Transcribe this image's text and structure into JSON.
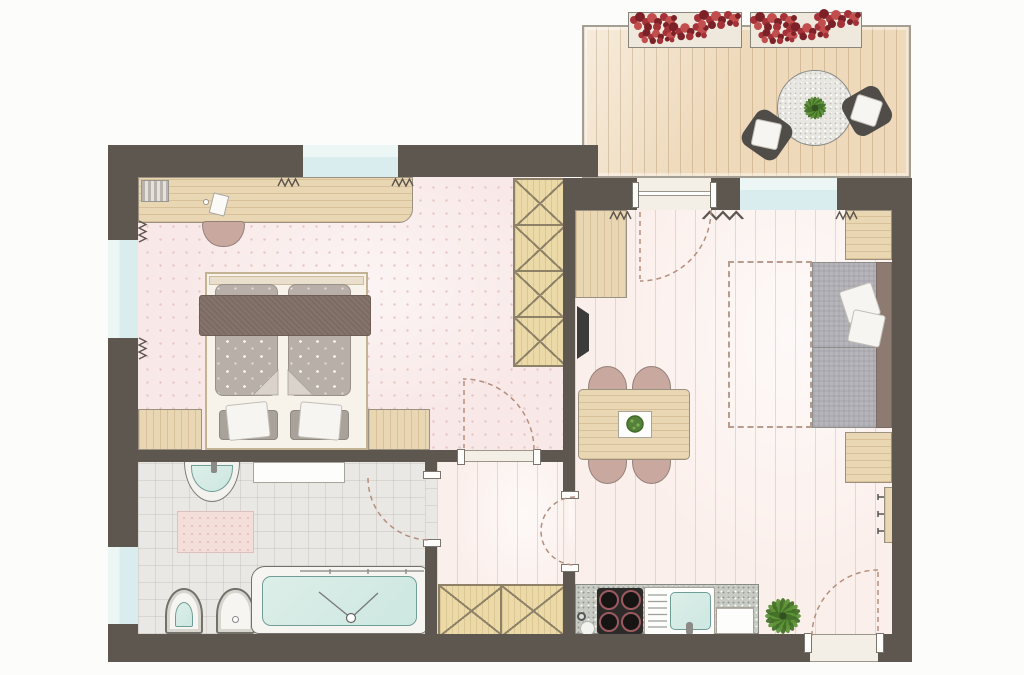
{
  "canvas": {
    "width": 1024,
    "height": 675
  },
  "colors": {
    "wall": "#5e574f",
    "background": "#fcfcfb",
    "bedroom_floor": "#f8e8e7",
    "bedroom_dot": "#e8c6c4",
    "living_floor": "#fbefeb",
    "plank_line": "#e3c2b8",
    "bath_floor": "#eae8e4",
    "bath_grid": "#d5d1cb",
    "deck": "#eed9ba",
    "deck_line": "#c8a87c",
    "glass": "#d9edee",
    "glass_light": "#ecf6f5",
    "wood": "#e9d6b2",
    "wood_border": "#9b9181",
    "wardrobe": "#ecd9a8",
    "wardrobe_line": "#8d8168",
    "blanket": "#7c6b62",
    "mattress": "#b8b0a8",
    "pillow_gray": "#a9a29a",
    "linen": "#f6f5f2",
    "chair_pink": "#c9a8a0",
    "chair_border": "#94817a",
    "sofa_gray": "#b5b5ba",
    "sofa_back": "#8d7a71",
    "granite": "#c8cac4",
    "granite_table": "#e9e7e2",
    "cooktop": "#2d2b29",
    "burner_ring": "#9c5a60",
    "teal": "#cde7e1",
    "teal_border": "#6f9e97",
    "arc": "#b58e7d",
    "rug_dash": "#b89c8e",
    "tv": "#3b3b3b",
    "green": "#5f9339",
    "green_dark": "#437029",
    "red": "#a53238",
    "red_dark": "#7c2127",
    "red_mid": "#c34e4e",
    "threshold": "#f3efe7",
    "threshold_line": "#9b958a",
    "metal": "#8a8a86"
  },
  "building": {
    "rooms": [
      {
        "id": "bedroom",
        "furniture": [
          "desk",
          "desk-chair",
          "double-bed",
          "bed-blanket",
          "bed-pillows",
          "wall-wardrobe-4-sections",
          "bench-left",
          "bench-right"
        ]
      },
      {
        "id": "bathroom",
        "furniture": [
          "washbasin",
          "wall-shelf",
          "bath-mat",
          "toilet",
          "bidet",
          "bathtub"
        ]
      },
      {
        "id": "hallway",
        "furniture": [
          "closet-2-sections"
        ]
      },
      {
        "id": "living-dining-kitchen",
        "furniture": [
          "sideboard",
          "tv",
          "dining-table",
          "dining-chairs-4",
          "serving-tray",
          "tray-plant",
          "sofa",
          "sofa-pillows-2",
          "side-cabinet-top",
          "side-cabinet-bottom",
          "rug-outline",
          "coat-rack",
          "kitchenette",
          "cooktop-4-burners",
          "kitchen-sink",
          "drainboard",
          "worktop-board",
          "potted-plant"
        ]
      },
      {
        "id": "balcony",
        "furniture": [
          "flower-box-left",
          "flower-box-right",
          "round-table",
          "outdoor-chairs-2",
          "table-plant"
        ]
      }
    ],
    "doors": [
      "balcony-sliding-door",
      "bedroom-door",
      "bathroom-door",
      "hallway-door",
      "entrance-door"
    ],
    "windows": [
      "bedroom-top-window",
      "bedroom-left-window",
      "bathroom-left-window",
      "living-room-window"
    ],
    "radiators": 7
  }
}
